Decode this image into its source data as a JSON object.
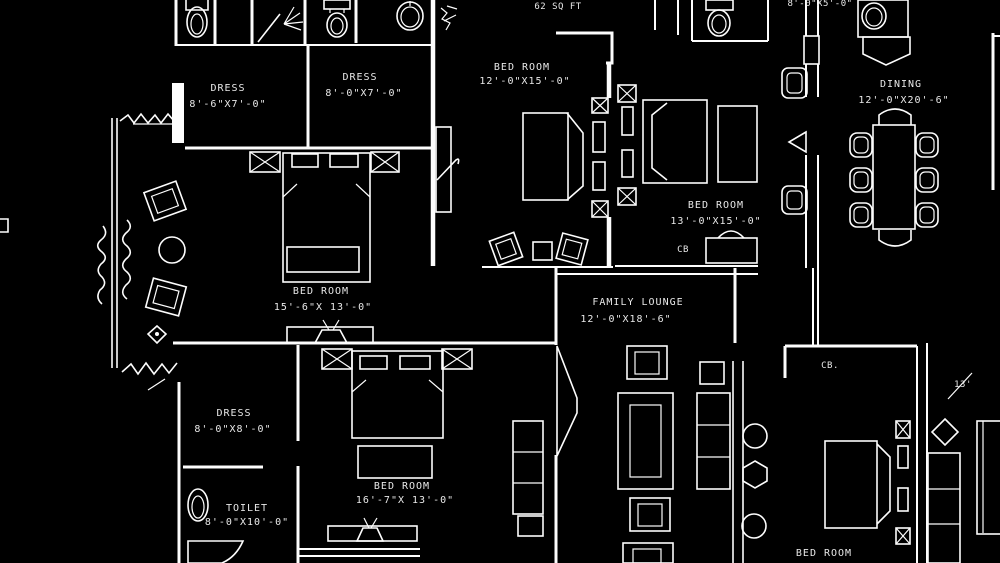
{
  "document": {
    "type": "architectural-floor-plan-blueprint",
    "colors": {
      "background": "#000000",
      "linework": "#ffffff",
      "text": "#e9e9e9"
    }
  },
  "rooms": {
    "dress1": {
      "name": "DRESS",
      "dims": "8'-6\"X7'-0\""
    },
    "dress2": {
      "name": "DRESS",
      "dims": "8'-0\"X7'-0\""
    },
    "bed_top": {
      "name": "BED ROOM",
      "dims": "12'-0\"X15'-0\""
    },
    "bed_mid": {
      "name": "BED ROOM",
      "dims": "13'-0\"X15'-0\""
    },
    "dining": {
      "name": "DINING",
      "dims": "12'-0\"X20'-6\""
    },
    "bed_left": {
      "name": "BED ROOM",
      "dims": "15'-6\"X 13'-0\""
    },
    "lounge": {
      "name": "FAMILY LOUNGE",
      "dims": "12'-0\"X18'-6\""
    },
    "dress3": {
      "name": "DRESS",
      "dims": "8'-0\"X8'-0\""
    },
    "toilet": {
      "name": "TOILET",
      "dims": "8'-0\"X10'-0\""
    },
    "bed_bottom": {
      "name": "BED ROOM",
      "dims": "16'-7\"X 13'-0\""
    },
    "bed_right": {
      "name": "BED ROOM"
    }
  },
  "annotations": {
    "area_sqft": "62 SQ FT",
    "closet_1": "CB",
    "closet_2": "CB.",
    "dim_fragment_top": "8'-0\"X5'-0\"",
    "dim_fragment_right": "13'"
  }
}
